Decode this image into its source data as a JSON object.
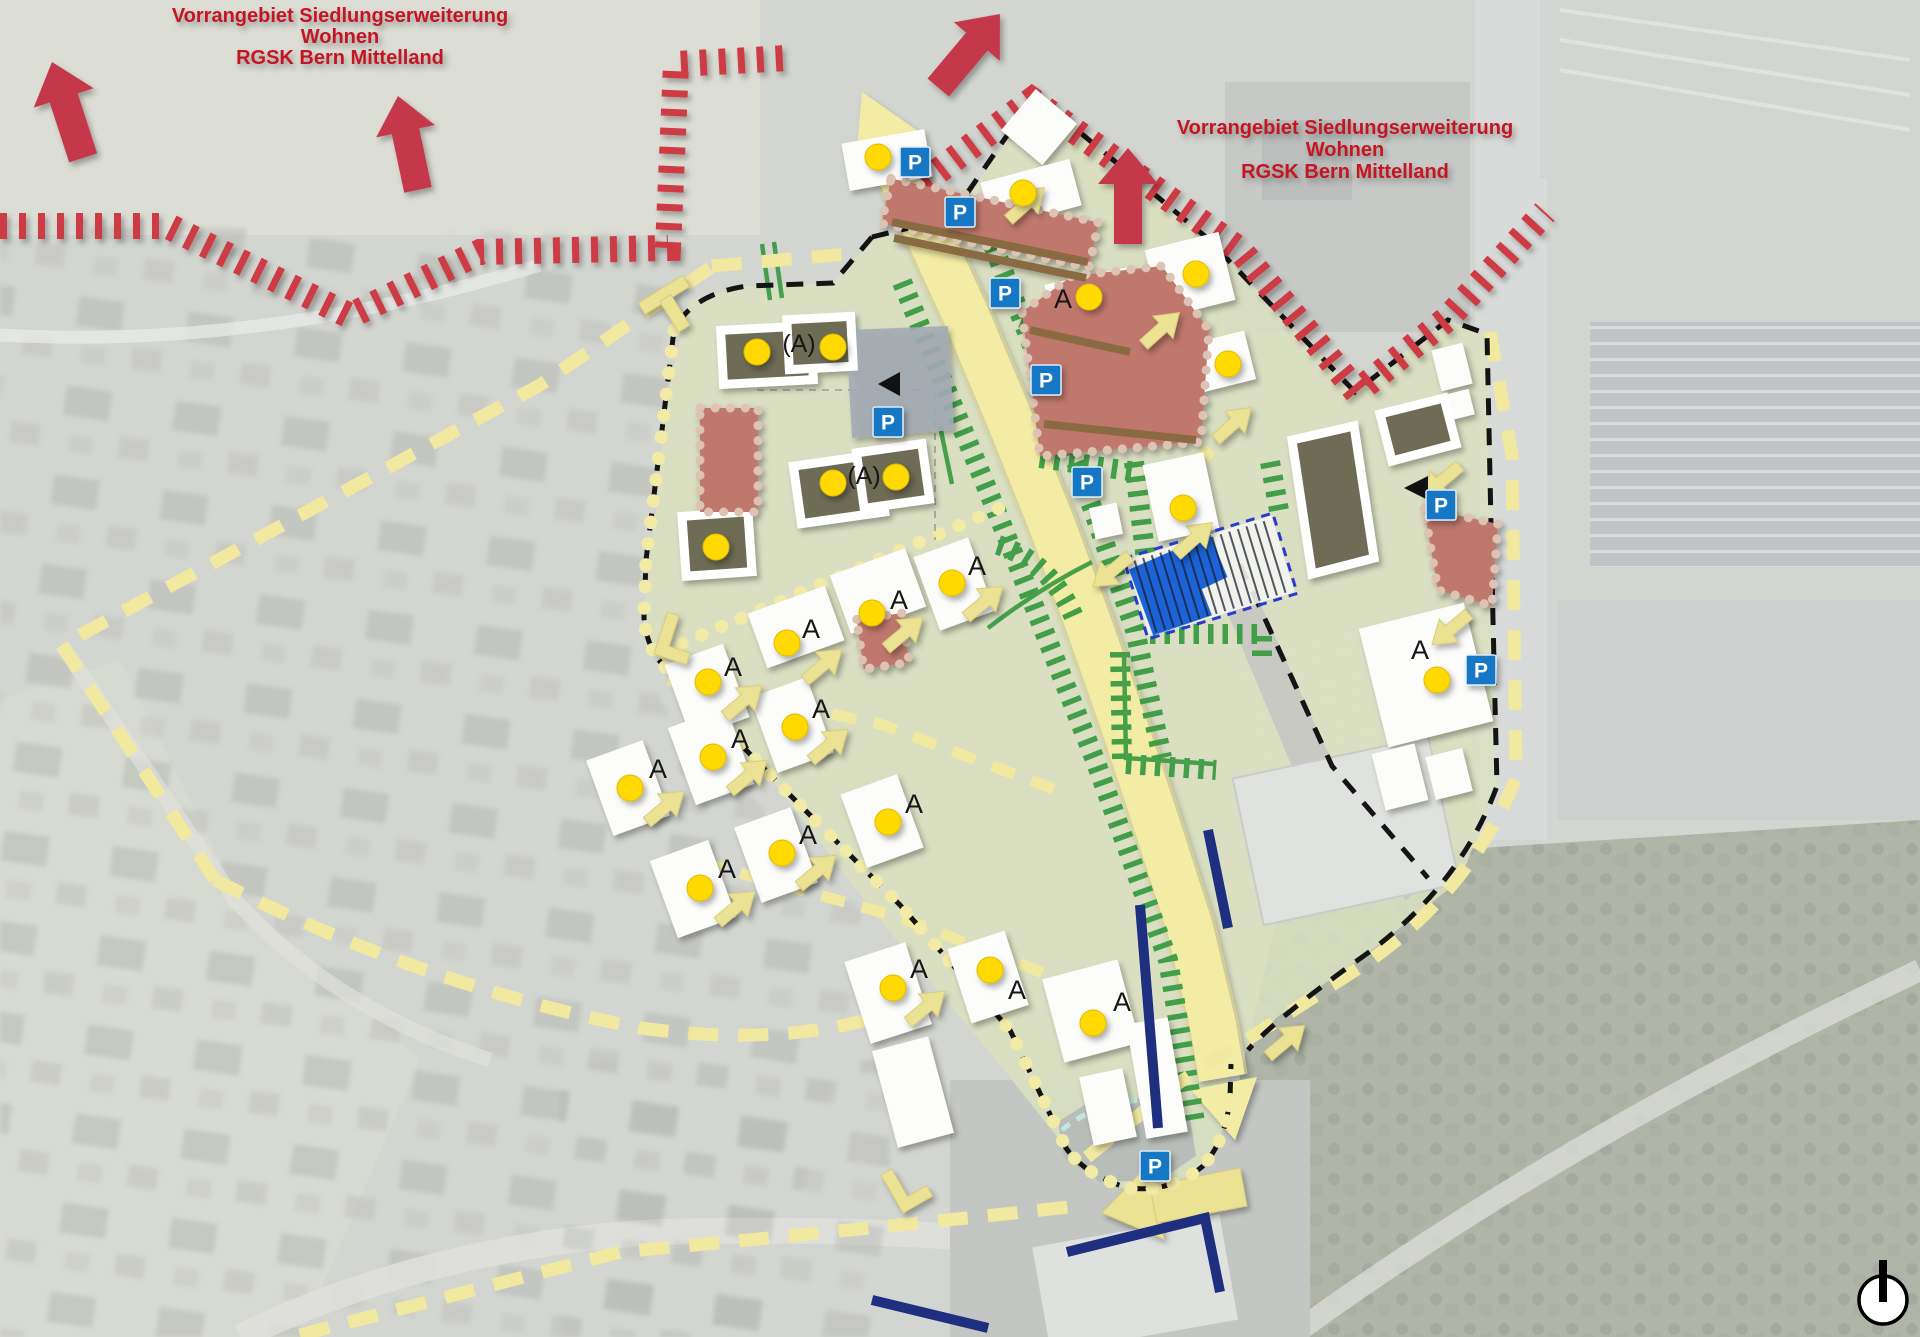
{
  "annotations": {
    "priority_area_left": {
      "lines": [
        "Vorrangebiet Siedlungserweiterung",
        "Wohnen",
        "RGSK Bern Mittelland"
      ]
    },
    "priority_area_right": {
      "lines": [
        "Vorrangebiet Siedlungserweiterung",
        "Wohnen",
        "RGSK Bern Mittelland"
      ]
    }
  },
  "legend_labels": {
    "unit": "A",
    "unit_conditional": "(A)",
    "parking": "P"
  },
  "markers": {
    "entrance_dots": [
      [
        757,
        352
      ],
      [
        833,
        347
      ],
      [
        833,
        483
      ],
      [
        896,
        477
      ],
      [
        716,
        547
      ],
      [
        708,
        682
      ],
      [
        787,
        643
      ],
      [
        872,
        613
      ],
      [
        952,
        583
      ],
      [
        630,
        788
      ],
      [
        713,
        757
      ],
      [
        795,
        727
      ],
      [
        700,
        888
      ],
      [
        782,
        853
      ],
      [
        888,
        822
      ],
      [
        893,
        988
      ],
      [
        990,
        970
      ],
      [
        1093,
        1023
      ],
      [
        878,
        157
      ],
      [
        1023,
        193
      ],
      [
        1089,
        297
      ],
      [
        1196,
        274
      ],
      [
        1228,
        364
      ],
      [
        1183,
        508
      ],
      [
        1437,
        680
      ]
    ],
    "unit_labels": [
      [
        733,
        667
      ],
      [
        811,
        629
      ],
      [
        899,
        600
      ],
      [
        977,
        566
      ],
      [
        658,
        769
      ],
      [
        740,
        739
      ],
      [
        821,
        709
      ],
      [
        727,
        869
      ],
      [
        808,
        835
      ],
      [
        914,
        804
      ],
      [
        919,
        969
      ],
      [
        1017,
        990
      ],
      [
        1122,
        1002
      ],
      [
        1063,
        299
      ],
      [
        1420,
        650
      ]
    ],
    "conditional_unit_labels": [
      [
        799,
        344
      ],
      [
        864,
        476
      ]
    ],
    "parking_signs": [
      [
        915,
        162
      ],
      [
        960,
        212
      ],
      [
        1005,
        293
      ],
      [
        1046,
        380
      ],
      [
        888,
        422
      ],
      [
        1087,
        482
      ],
      [
        1441,
        505
      ],
      [
        1481,
        670
      ],
      [
        1155,
        1166
      ]
    ],
    "view_triangles": [
      {
        "points": "900,372 878,384 900,396"
      },
      {
        "points": "1428,476 1404,488 1428,500"
      }
    ]
  },
  "colors": {
    "priority_text_red": "#c41420",
    "arrow_red": "#c5394a",
    "hatch_red": "#cd3b45",
    "planning_green": "#dbe1bf",
    "road_yellow": "#f3eca5",
    "dash_yellow": "#f1e9a0",
    "hedge_green": "#3a9b42",
    "building_olive": "#6e6c55",
    "building_red": "#c0786d",
    "building_white": "#fcfcfa",
    "parking_sign_blue": "#1878c4",
    "parking_lot_blue": "#1b63d6",
    "transit_navy": "#1e2f80",
    "boundary_black": "#141414"
  },
  "compass": {
    "type": "north-indicator"
  }
}
